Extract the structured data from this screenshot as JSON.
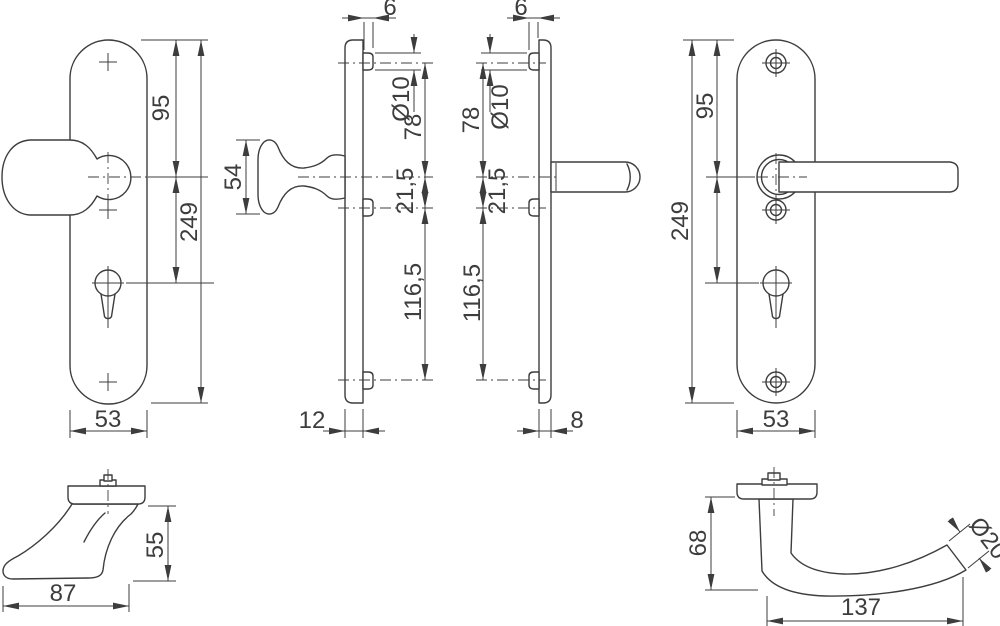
{
  "page": {
    "background": "#ffffff",
    "line_color": "#3d3d3d"
  },
  "views": {
    "knob_plate_front": {
      "dims": {
        "center_to_top": "95",
        "total_height": "249",
        "plate_width": "53"
      }
    },
    "knob_plate_side": {
      "dims": {
        "peg_length": "6",
        "hole_dia": "Ø10",
        "top_to_center": "78",
        "center_to_lower": "21,5",
        "lower_to_bottom": "116,5",
        "knob_height": "54",
        "plate_thickness": "12"
      }
    },
    "lever_plate_side": {
      "dims": {
        "peg_length": "6",
        "hole_dia": "Ø10",
        "top_to_center": "78",
        "center_to_lower": "21,5",
        "lower_to_bottom": "116,5",
        "plate_thickness": "8"
      }
    },
    "lever_plate_front": {
      "dims": {
        "center_to_top": "95",
        "total_height": "249",
        "plate_width": "53"
      }
    },
    "knob_profile": {
      "dims": {
        "projection": "87",
        "height": "55"
      }
    },
    "lever_profile": {
      "dims": {
        "height": "68",
        "length": "137",
        "tube_dia": "Ø20"
      }
    }
  }
}
